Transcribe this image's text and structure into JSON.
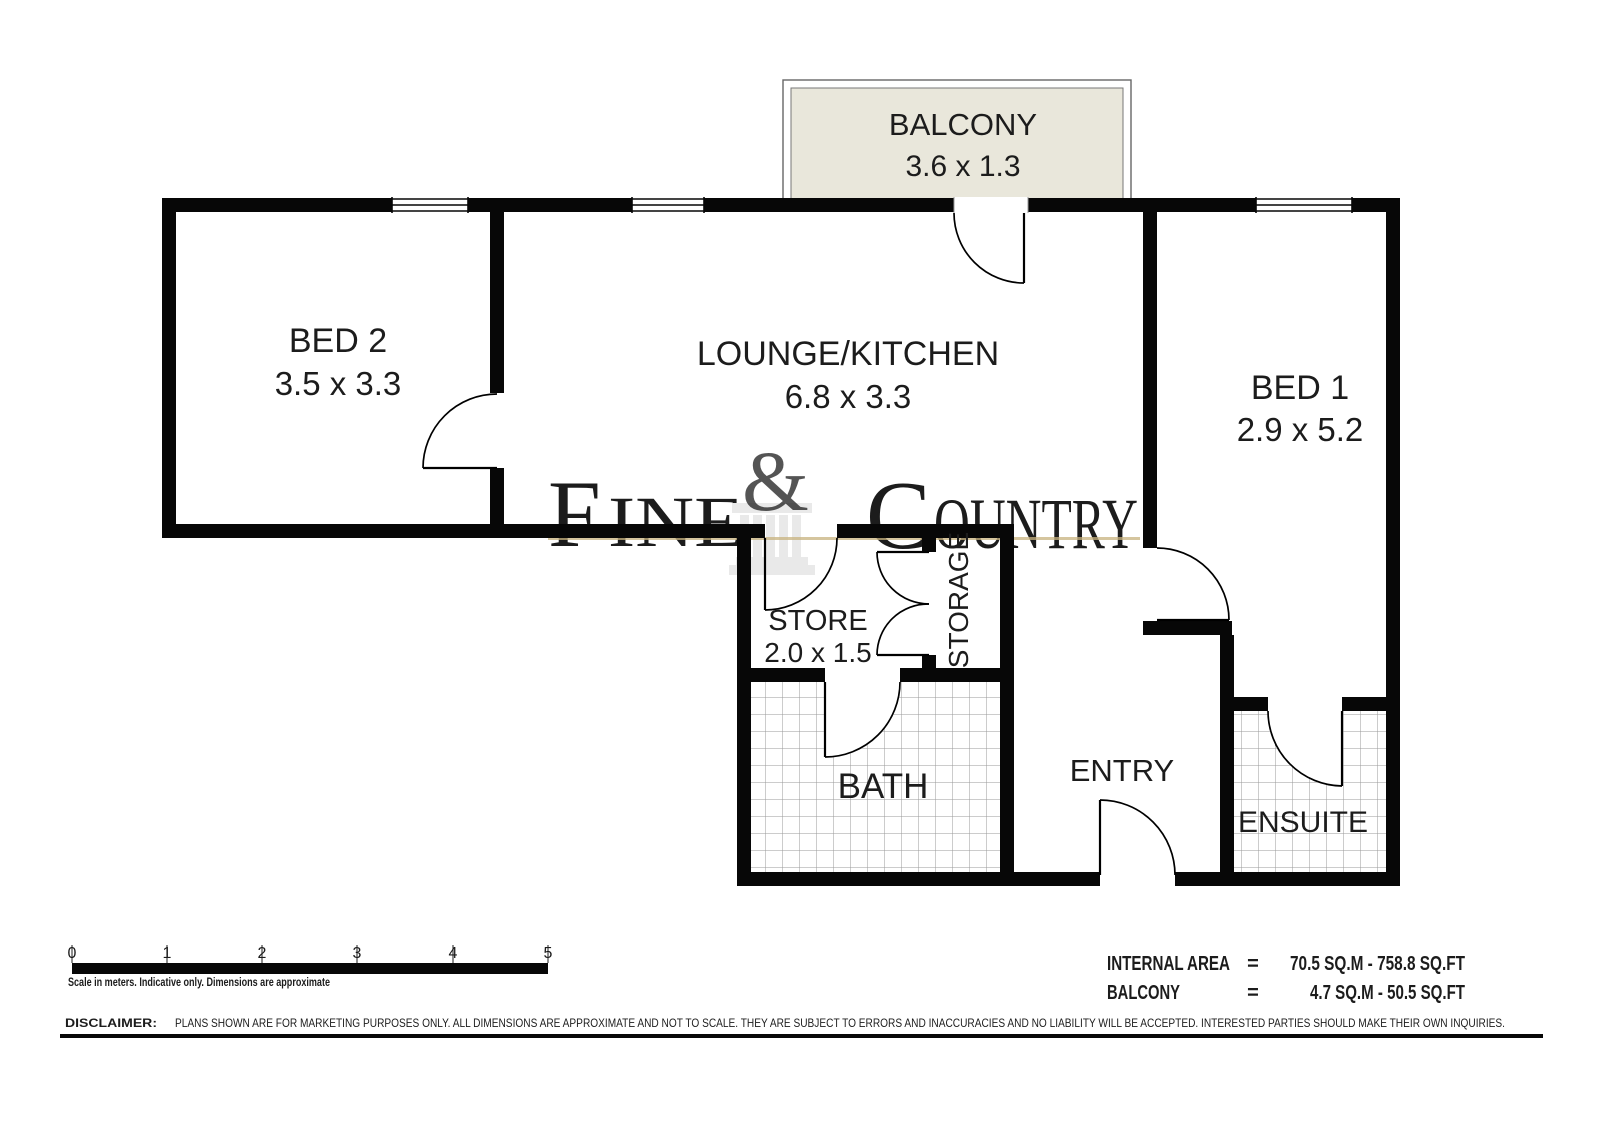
{
  "plan": {
    "rooms": {
      "balcony": {
        "label": "BALCONY",
        "dims": "3.6 x 1.3"
      },
      "bed2": {
        "label": "BED 2",
        "dims": "3.5 x 3.3"
      },
      "lounge": {
        "label": "LOUNGE/KITCHEN",
        "dims": "6.8 x 3.3"
      },
      "bed1": {
        "label": "BED 1",
        "dims": "2.9 x 5.2"
      },
      "store": {
        "label": "STORE",
        "dims": "2.0 x 1.5"
      },
      "storage": {
        "label": "STORAGE"
      },
      "bath": {
        "label": "BATH"
      },
      "entry": {
        "label": "ENTRY"
      },
      "ensuite": {
        "label": "ENSUITE"
      }
    },
    "watermark": {
      "left_initial": "F",
      "left_rest": "INE",
      "ampersand": "&",
      "right_initial": "C",
      "right_rest": "OUNTRY"
    }
  },
  "scale_bar": {
    "ticks": [
      "0",
      "1",
      "2",
      "3",
      "4",
      "5"
    ],
    "caption": "Scale in meters. Indicative only. Dimensions are approximate"
  },
  "areas": {
    "rows": [
      {
        "label": "INTERNAL AREA",
        "eq": "=",
        "value": "70.5 SQ.M - 758.8 SQ.FT"
      },
      {
        "label": "BALCONY",
        "eq": "=",
        "value": "4.7 SQ.M - 50.5 SQ.FT"
      }
    ]
  },
  "disclaimer": {
    "label": "DISCLAIMER:",
    "text": "PLANS SHOWN ARE FOR MARKETING PURPOSES ONLY. ALL DIMENSIONS ARE APPROXIMATE AND NOT TO SCALE. THEY ARE SUBJECT TO ERRORS AND INACCURACIES AND NO LIABILITY WILL BE ACCEPTED. INTERESTED PARTIES SHOULD MAKE THEIR OWN INQUIRIES."
  },
  "colors": {
    "wall": "#070707",
    "balcony_fill": "#e9e7db",
    "watermark_gray": "#ececec",
    "watermark_gold": "#ddc795",
    "tile_line": "#9a9a9a"
  }
}
